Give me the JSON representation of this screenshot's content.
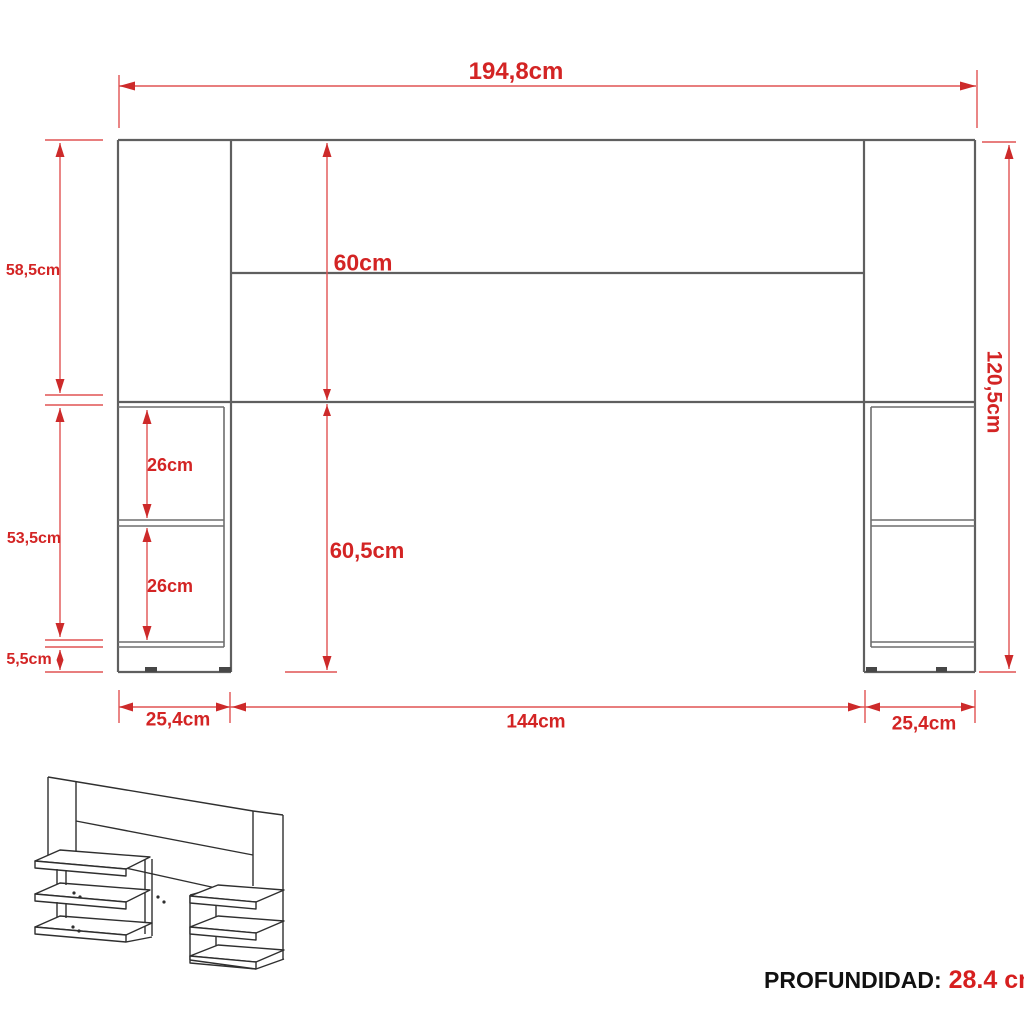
{
  "front_view": {
    "width_total": "194,8cm",
    "height_total": "120,5cm",
    "left_upper_height": "58,5cm",
    "left_middle_height": "53,5cm",
    "left_base_height": "5,5cm",
    "headboard_panel_height": "60cm",
    "lower_section_height": "60,5cm",
    "shelf_gap_upper": "26cm",
    "shelf_gap_lower": "26cm",
    "bottom_left_width": "25,4cm",
    "bottom_center_width": "144cm",
    "bottom_right_width": "25,4cm"
  },
  "footer": {
    "depth_label": "PROFUNDIDAD:",
    "depth_value": "28.4 cm"
  },
  "colors": {
    "dimension_red": "#d32424",
    "outline_gray": "#5f5f5f",
    "sketch_black": "#2f2f2f"
  }
}
